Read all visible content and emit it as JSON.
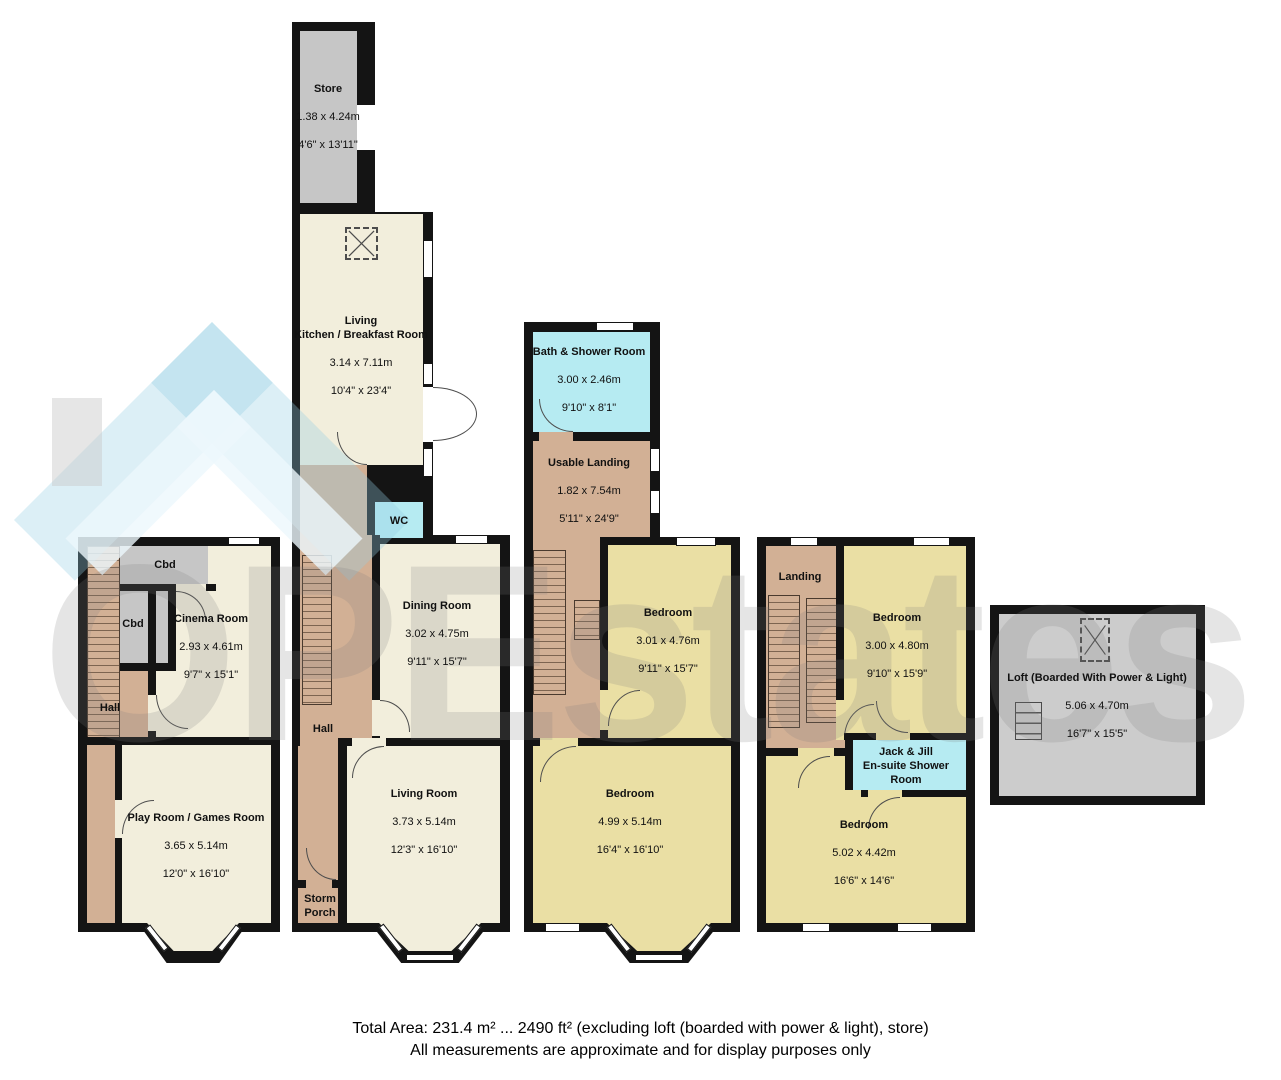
{
  "watermark": {
    "text": "OPEstates",
    "logo": "house-roof-icon"
  },
  "colors": {
    "wall": "#141414",
    "reception_cream": "#f2eedc",
    "bedroom_yellow": "#eadfa4",
    "hall_tan": "#d2b095",
    "store_gray": "#c6c6c6",
    "wet_room_cyan": "#b6ebf2",
    "watermark_blue": "#96cde2",
    "watermark_gray": "#7d7d7d"
  },
  "rooms": {
    "store": {
      "name": "Store",
      "metric": "1.38 x 4.24m",
      "imperial": "4'6\" x 13'11\""
    },
    "kitchen": {
      "name": "Living\nKitchen / Breakfast Room",
      "metric": "3.14 x 7.11m",
      "imperial": "10'4\" x 23'4\""
    },
    "wc": {
      "name": "WC"
    },
    "cbd1": {
      "name": "Cbd"
    },
    "cbd2": {
      "name": "Cbd"
    },
    "cinema": {
      "name": "Cinema Room",
      "metric": "2.93 x 4.61m",
      "imperial": "9'7\" x 15'1\""
    },
    "hall_front": {
      "name": "Hall"
    },
    "playroom": {
      "name": "Play Room / Games Room",
      "metric": "3.65 x 5.14m",
      "imperial": "12'0\" x 16'10\""
    },
    "dining": {
      "name": "Dining Room",
      "metric": "3.02 x 4.75m",
      "imperial": "9'11\" x 15'7\""
    },
    "hall": {
      "name": "Hall"
    },
    "living": {
      "name": "Living Room",
      "metric": "3.73 x 5.14m",
      "imperial": "12'3\" x 16'10\""
    },
    "storm_porch": {
      "name": "Storm\nPorch"
    },
    "bath": {
      "name": "Bath & Shower Room",
      "metric": "3.00 x 2.46m",
      "imperial": "9'10\" x 8'1\""
    },
    "usable_landing": {
      "name": "Usable Landing",
      "metric": "1.82 x 7.54m",
      "imperial": "5'11\" x 24'9\""
    },
    "bedroom1": {
      "name": "Bedroom",
      "metric": "3.01 x 4.76m",
      "imperial": "9'11\" x 15'7\""
    },
    "bedroom2": {
      "name": "Bedroom",
      "metric": "4.99 x 5.14m",
      "imperial": "16'4\" x 16'10\""
    },
    "landing": {
      "name": "Landing"
    },
    "bedroom3": {
      "name": "Bedroom",
      "metric": "3.00 x 4.80m",
      "imperial": "9'10\" x 15'9\""
    },
    "jack_jill": {
      "name": "Jack & Jill\nEn-suite Shower\nRoom"
    },
    "bedroom4": {
      "name": "Bedroom",
      "metric": "5.02 x 4.42m",
      "imperial": "16'6\" x 14'6\""
    },
    "loft": {
      "name": "Loft (Boarded With Power & Light)",
      "metric": "5.06 x 4.70m",
      "imperial": "16'7\" x 15'5\""
    }
  },
  "footer": {
    "total": "Total Area: 231.4 m² ... 2490 ft² (excluding loft (boarded with power & light), store)",
    "disclaimer": "All measurements are approximate and for display purposes only"
  }
}
